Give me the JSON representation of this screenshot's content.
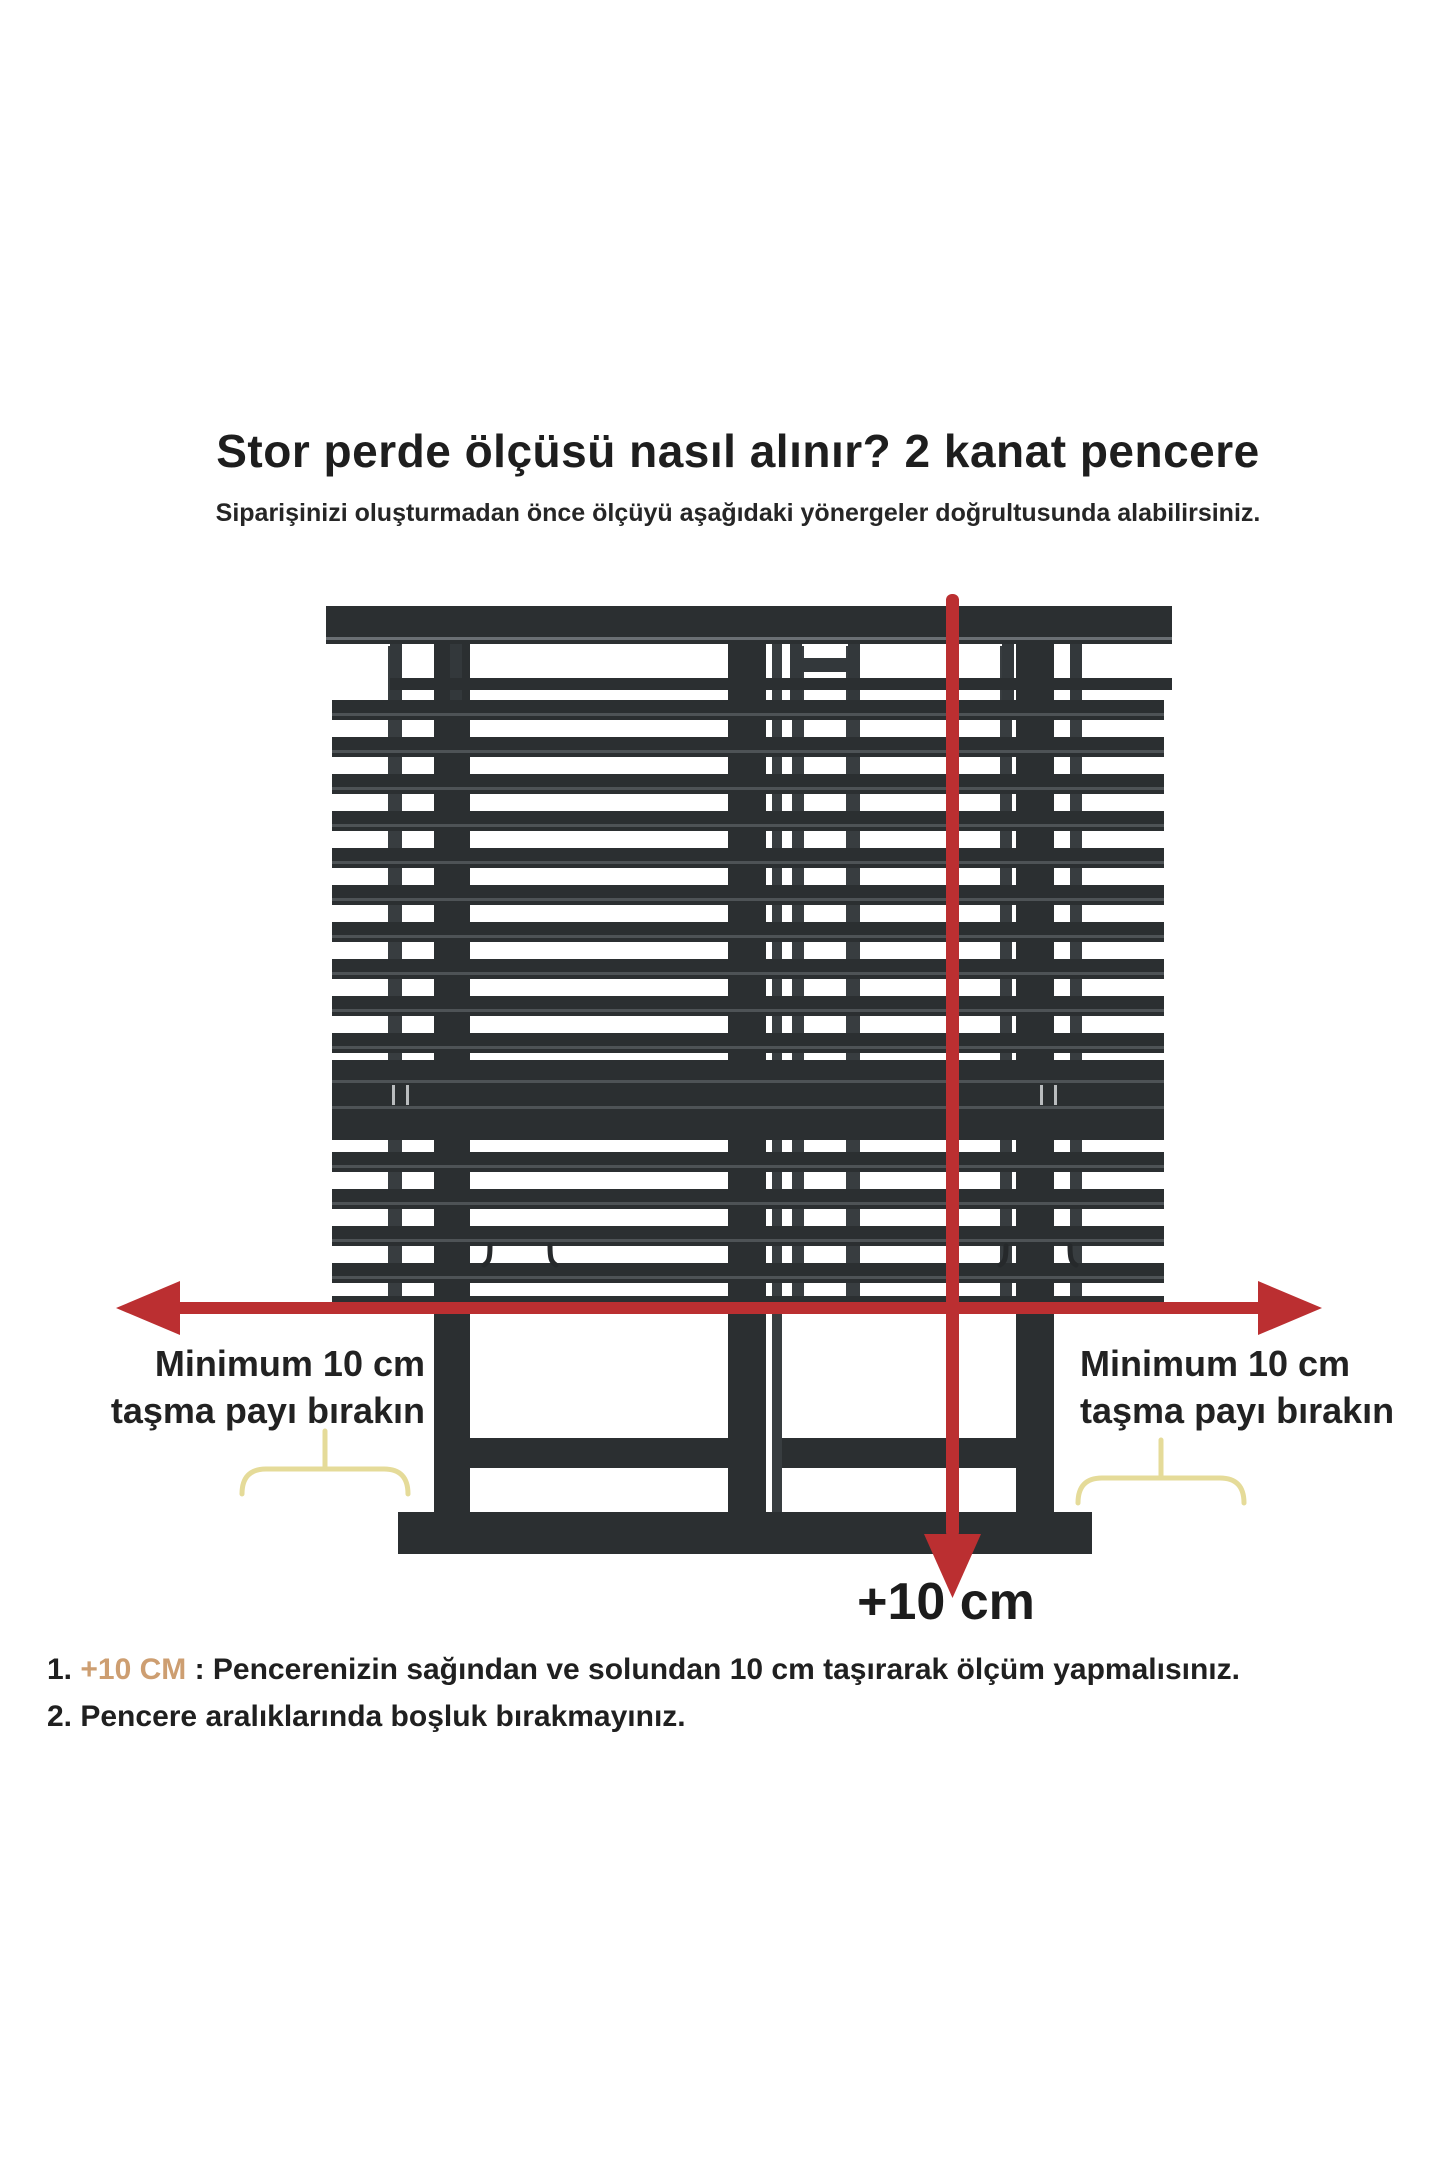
{
  "header": {
    "title": "Stor perde ölçüsü nasıl alınır? 2 kanat pencere",
    "subtitle": "Siparişinizi oluşturmadan önce ölçüyü aşağıdaki yönergeler doğrultusunda alabilirsiniz."
  },
  "diagram": {
    "left_overhang_label": {
      "line1": "Minimum 10 cm",
      "line2": "taşma payı bırakın"
    },
    "right_overhang_label": {
      "line1": "Minimum 10 cm",
      "line2": "taşma payı bırakın"
    },
    "height_arrow_label": "+10 cm",
    "colors": {
      "frame_dark": "#2b2f31",
      "sash_dark": "#383d40",
      "slat_inner_line": "#4e5356",
      "rail_highlight": "#6a6f73",
      "band_tick": "#b9bcbe",
      "arrow_red": "#bb2f31",
      "brace_yellow": "#e5db99",
      "background": "#ffffff"
    }
  },
  "instructions": {
    "item1": {
      "number": "1. ",
      "highlight": "+10 CM",
      "text": " : Pencerenizin sağından ve solundan 10 cm taşırarak ölçüm yapmalısınız."
    },
    "item2": {
      "number": "2. ",
      "text": "Pencere aralıklarında boşluk bırakmayınız."
    },
    "highlight_color": "#cd9e71"
  }
}
